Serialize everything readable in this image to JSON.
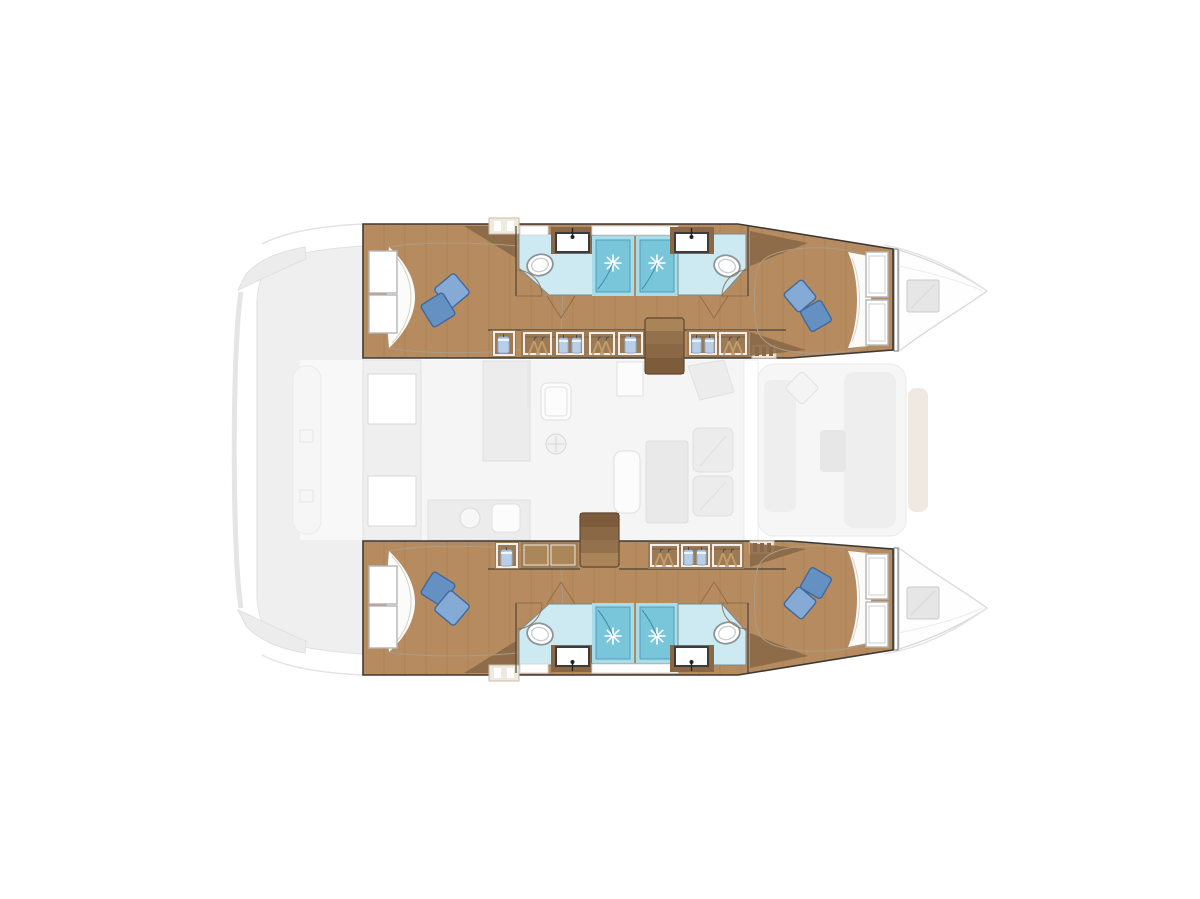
{
  "document": {
    "type": "boat-floor-plan",
    "subject": "catamaran-4-cabin-layout-top-view",
    "orientation": "bow-right"
  },
  "palette": {
    "background": "#ffffff",
    "hull_outline": "#3d3a36",
    "wood_floor": "#b68b60",
    "wood_dark": "#8a6847",
    "wood_panel": "#a07c52",
    "panel_face": "#ab8659",
    "step_1": "#a98459",
    "step_2": "#93714c",
    "step_3": "#8a6845",
    "step_4": "#7d5c3b",
    "bed_beige": "#cabda5",
    "duvet": "#fbfbf9",
    "pillow_light": "#85aad6",
    "pillow_dark": "#6590c2",
    "bath_floor": "#cde9f2",
    "shower_trim": "#a9dcea",
    "shower_floor": "#79c5da",
    "wardrobe_bg": "#9b7a55",
    "shirt_blue": "#b9cfe8",
    "hanger_tan": "#c49a66",
    "ghost_fill": "#efefef",
    "ghost_mid": "#ececec",
    "ghost_soft": "#f6f6f6",
    "saloon_bg": "#f5f5f5",
    "hatch_gray": "#e6e6e6",
    "beam_tan": "#efe9e2"
  },
  "plan": {
    "hulls": [
      {
        "id": "port-hull",
        "side": "top",
        "rooms": [
          "aft-double-cabin",
          "aft-bathroom",
          "shower-1",
          "shower-2",
          "forward-bathroom",
          "forward-double-cabin"
        ],
        "beds": 2,
        "pillows_per_bed": 2,
        "storage": [
          "shelf-headboard",
          "blue-shirt-locker",
          "wardrobe-hangers",
          "wardrobe-shirts",
          "wardrobe-hangers",
          "wardrobe-shirt",
          "wardrobe-shirts",
          "wardrobe-hangers",
          "slatted-locker"
        ],
        "stairs": "companionway-4-steps"
      },
      {
        "id": "starboard-hull",
        "side": "bottom",
        "rooms": [
          "aft-double-cabin",
          "aft-bathroom",
          "shower-1",
          "shower-2",
          "forward-bathroom",
          "forward-double-cabin"
        ],
        "beds": 2,
        "pillows_per_bed": 2,
        "storage": [
          "shelf-headboard",
          "blue-shirt-locker",
          "cabinet-doors",
          "wardrobe-hangers",
          "wardrobe-shirts",
          "wardrobe-hangers",
          "slatted-locker"
        ],
        "stairs": "companionway-4-steps"
      }
    ],
    "bridgedeck": {
      "ghosted": true,
      "areas": [
        "aft-cockpit-bench",
        "transom-steps",
        "saloon-galley",
        "dinette-table",
        "nav-seating",
        "forward-lounge",
        "bow-deck-hatches"
      ]
    },
    "icons": [
      "shower-spray-icon",
      "toilet-icon",
      "sink-faucet-icon",
      "clothes-hanger-icon",
      "shirt-icon",
      "stairs-icon",
      "deck-hatch-icon",
      "pillow-icon",
      "burner-icon"
    ]
  }
}
